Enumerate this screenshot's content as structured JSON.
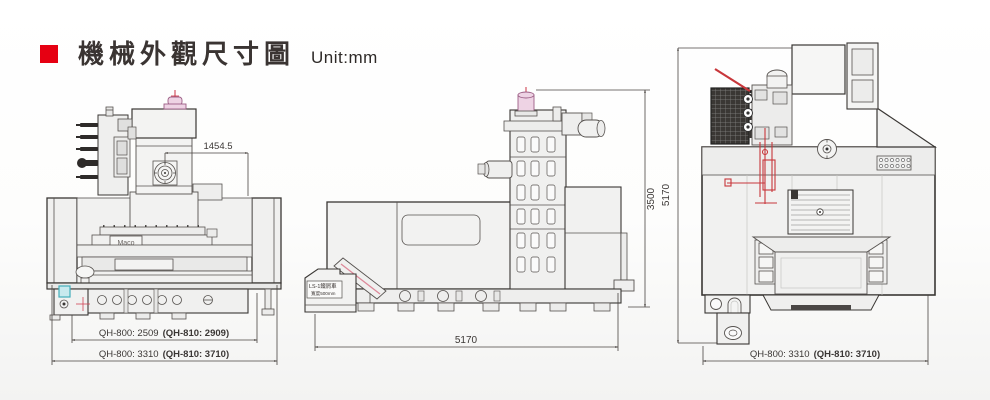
{
  "header": {
    "title": "機械外觀尺寸圖",
    "unit": "Unit:mm",
    "bullet_color": "#e60012"
  },
  "views": {
    "front": {
      "dim_head": "1454.5",
      "logo": "Maco",
      "dim_table": {
        "normal": "QH-800: 2509",
        "bold": "(QH-810: 2909)"
      },
      "dim_overall": {
        "normal": "QH-800: 3310",
        "bold": "(QH-810: 3710)"
      }
    },
    "side": {
      "dim_height": "3500",
      "dim_length": "5170",
      "chip_cart": {
        "line1": "LS-1鐵屑車",
        "line2": "寬度500mm"
      }
    },
    "top": {
      "dim_depth": "5170",
      "dim_overall": {
        "normal": "QH-800: 3310",
        "bold": "(QH-810: 3710)"
      }
    }
  },
  "colors": {
    "accent_red": "#e60012",
    "drawing_line": "#4a4542",
    "highlight_red": "#c8373b",
    "pink_part": "#eed3e4",
    "teal_part": "#c8e9ee"
  }
}
